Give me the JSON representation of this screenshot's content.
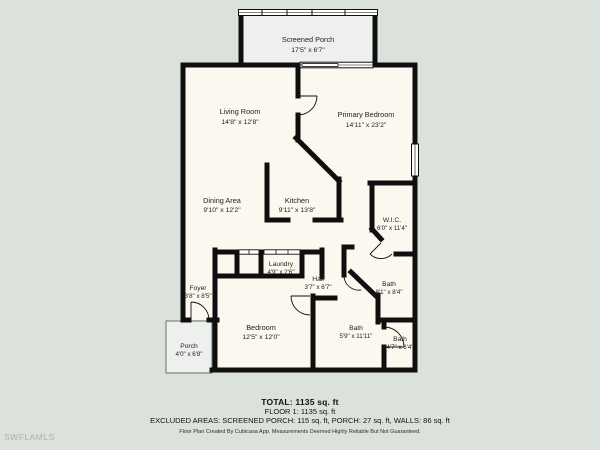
{
  "colors": {
    "background": "#dbe2db",
    "floor": "#fbf8ef",
    "porch_floor": "#eef0ee",
    "wall": "#0f0f0f",
    "watermark": "#a9b3a9"
  },
  "rooms": [
    {
      "name": "Screened Porch",
      "dims": "17'5\" x 6'7\""
    },
    {
      "name": "Living Room",
      "dims": "14'8\" x 12'8\""
    },
    {
      "name": "Primary Bedroom",
      "dims": "14'11\" x 23'2\""
    },
    {
      "name": "Dining Area",
      "dims": "9'10\" x 12'2\""
    },
    {
      "name": "Kitchen",
      "dims": "9'11\" x 13'8\""
    },
    {
      "name": "W.I.C.",
      "dims": "6'0\" x 11'4\""
    },
    {
      "name": "Laundry",
      "dims": "4'9\" x 2'6\""
    },
    {
      "name": "Hall",
      "dims": "3'7\" x 6'7\""
    },
    {
      "name": "Foyer",
      "dims": "3'8\" x 8'5\""
    },
    {
      "name": "Bath",
      "dims": "8'1\" x 8'4\""
    },
    {
      "name": "Bedroom",
      "dims": "12'5\" x 12'0\""
    },
    {
      "name": "Bath",
      "dims": "5'9\" x 11'11\""
    },
    {
      "name": "Bath",
      "dims": "4'7\" x 6'4\""
    },
    {
      "name": "Porch",
      "dims": "4'0\" x 6'8\""
    }
  ],
  "footer": {
    "total": "TOTAL: 1135 sq. ft",
    "floor": "FLOOR 1: 1135 sq. ft",
    "excluded": "EXCLUDED AREAS: SCREENED PORCH: 115 sq. ft, PORCH: 27 sq. ft, WALLS: 86 sq. ft",
    "disclaimer": "Floor Plan Created By Cubicasa App. Measurements Deemed Highly Reliable But Not Guaranteed."
  },
  "watermark": "SWFLAMLS"
}
